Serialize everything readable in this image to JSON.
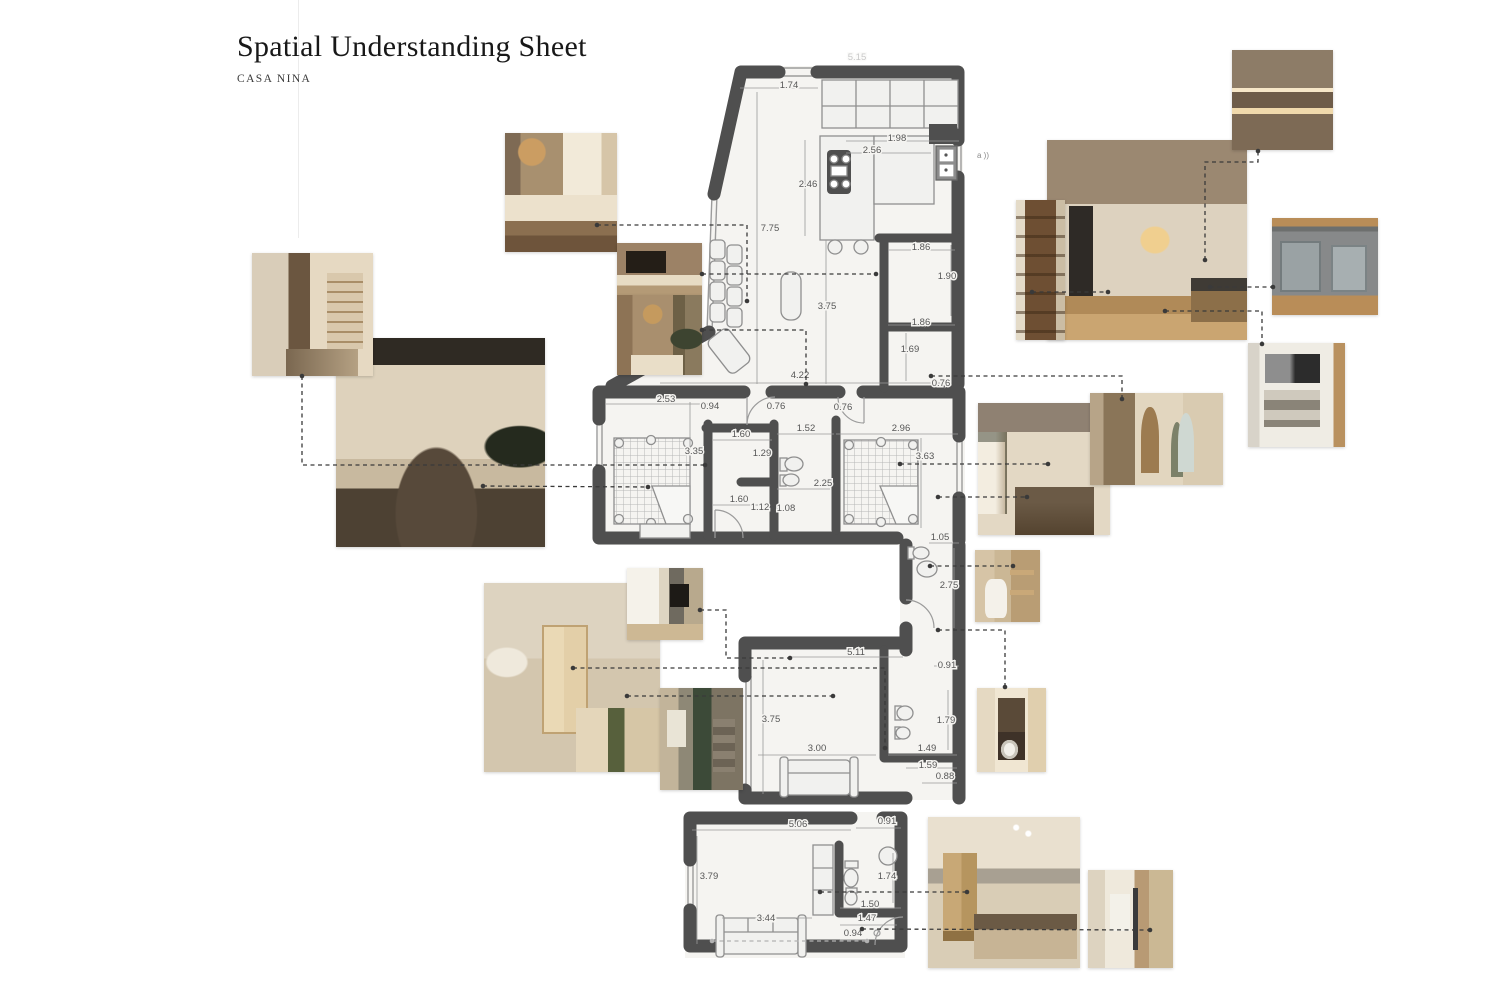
{
  "header": {
    "title": "Spatial Understanding Sheet",
    "subtitle": "CASA NINA"
  },
  "plan": {
    "dimensions": [
      {
        "t": "5.15",
        "x": 857,
        "y": 60,
        "f": 1
      },
      {
        "t": "1.74",
        "x": 789,
        "y": 88
      },
      {
        "t": "1.98",
        "x": 897,
        "y": 141
      },
      {
        "t": "2.56",
        "x": 872,
        "y": 153
      },
      {
        "t": "2.46",
        "x": 808,
        "y": 187
      },
      {
        "t": "7.75",
        "x": 770,
        "y": 231
      },
      {
        "t": "1.86",
        "x": 921,
        "y": 250
      },
      {
        "t": "1.90",
        "x": 947,
        "y": 279
      },
      {
        "t": "3.75",
        "x": 827,
        "y": 309
      },
      {
        "t": "1.86",
        "x": 921,
        "y": 325
      },
      {
        "t": "1.69",
        "x": 910,
        "y": 352
      },
      {
        "t": "4.22",
        "x": 800,
        "y": 378
      },
      {
        "t": "0.76",
        "x": 941,
        "y": 386
      },
      {
        "t": "2.53",
        "x": 666,
        "y": 402
      },
      {
        "t": "0.94",
        "x": 710,
        "y": 409
      },
      {
        "t": "0.76",
        "x": 776,
        "y": 409
      },
      {
        "t": "0.76",
        "x": 843,
        "y": 410
      },
      {
        "t": "1.52",
        "x": 806,
        "y": 431
      },
      {
        "t": "2.96",
        "x": 901,
        "y": 431
      },
      {
        "t": "1.60",
        "x": 741,
        "y": 437
      },
      {
        "t": "3.35",
        "x": 694,
        "y": 454
      },
      {
        "t": "1.29",
        "x": 762,
        "y": 456
      },
      {
        "t": "3.63",
        "x": 925,
        "y": 459
      },
      {
        "t": "2.25",
        "x": 823,
        "y": 486
      },
      {
        "t": "1.60",
        "x": 739,
        "y": 502
      },
      {
        "t": "1.12",
        "x": 760,
        "y": 510
      },
      {
        "t": "1.08",
        "x": 786,
        "y": 511
      },
      {
        "t": "1.05",
        "x": 940,
        "y": 540
      },
      {
        "t": "2.75",
        "x": 949,
        "y": 588
      },
      {
        "t": "5.11",
        "x": 856,
        "y": 655
      },
      {
        "t": "0.91",
        "x": 947,
        "y": 668
      },
      {
        "t": "3.75",
        "x": 771,
        "y": 722
      },
      {
        "t": "1.79",
        "x": 946,
        "y": 723
      },
      {
        "t": "3.00",
        "x": 817,
        "y": 751
      },
      {
        "t": "1.49",
        "x": 927,
        "y": 751
      },
      {
        "t": "1.59",
        "x": 928,
        "y": 768
      },
      {
        "t": "0.88",
        "x": 945,
        "y": 779
      },
      {
        "t": "0.91",
        "x": 887,
        "y": 824
      },
      {
        "t": "5.06",
        "x": 798,
        "y": 827
      },
      {
        "t": "3.79",
        "x": 709,
        "y": 879
      },
      {
        "t": "1.74",
        "x": 887,
        "y": 879
      },
      {
        "t": "1.50",
        "x": 870,
        "y": 907
      },
      {
        "t": "3.44",
        "x": 766,
        "y": 921
      },
      {
        "t": "1.47",
        "x": 867,
        "y": 921
      },
      {
        "t": "0.94",
        "x": 853,
        "y": 936
      }
    ],
    "annotations": [
      {
        "t": "a ))",
        "x": 977,
        "y": 158
      }
    ],
    "dimension_lines": [
      [
        740,
        88,
        818,
        88
      ],
      [
        846,
        141,
        959,
        141
      ],
      [
        846,
        153,
        931,
        153
      ],
      [
        805,
        140,
        805,
        236
      ],
      [
        757,
        92,
        757,
        384
      ],
      [
        826,
        240,
        826,
        384
      ],
      [
        888,
        250,
        955,
        250
      ],
      [
        951,
        245,
        951,
        316
      ],
      [
        888,
        325,
        955,
        325
      ],
      [
        906,
        333,
        906,
        381
      ],
      [
        660,
        383,
        940,
        383
      ],
      [
        606,
        404,
        712,
        404
      ],
      [
        777,
        434,
        834,
        434
      ],
      [
        836,
        434,
        958,
        434
      ],
      [
        713,
        440,
        772,
        440
      ],
      [
        690,
        402,
        690,
        524
      ],
      [
        921,
        438,
        921,
        528
      ],
      [
        777,
        489,
        830,
        489
      ],
      [
        713,
        505,
        770,
        505
      ],
      [
        929,
        543,
        959,
        543
      ],
      [
        954,
        548,
        954,
        628
      ],
      [
        790,
        657,
        903,
        657
      ],
      [
        934,
        666,
        959,
        666
      ],
      [
        763,
        660,
        763,
        794
      ],
      [
        758,
        755,
        876,
        755
      ],
      [
        948,
        690,
        948,
        750
      ],
      [
        888,
        755,
        957,
        755
      ],
      [
        906,
        768,
        957,
        768
      ],
      [
        922,
        783,
        957,
        783
      ],
      [
        692,
        830,
        851,
        830
      ],
      [
        856,
        828,
        901,
        828
      ],
      [
        697,
        836,
        697,
        944
      ],
      [
        893,
        853,
        893,
        903
      ],
      [
        840,
        908,
        901,
        908
      ],
      [
        722,
        918,
        812,
        918
      ],
      [
        840,
        925,
        897,
        925
      ],
      [
        840,
        940,
        868,
        940
      ]
    ]
  },
  "leader_lines": {
    "dark": [
      {
        "pts": [
          [
            597,
            225
          ],
          [
            747,
            225
          ],
          [
            747,
            301
          ]
        ]
      },
      {
        "pts": [
          [
            702,
            274
          ],
          [
            876,
            274
          ]
        ]
      },
      {
        "pts": [
          [
            702,
            330
          ],
          [
            806,
            330
          ],
          [
            806,
            384
          ]
        ]
      },
      {
        "pts": [
          [
            302,
            376
          ],
          [
            302,
            465
          ],
          [
            705,
            465
          ]
        ]
      },
      {
        "pts": [
          [
            483,
            486
          ],
          [
            648,
            487
          ]
        ]
      },
      {
        "pts": [
          [
            900,
            464
          ],
          [
            1048,
            464
          ]
        ]
      },
      {
        "pts": [
          [
            931,
            376
          ],
          [
            1122,
            376
          ],
          [
            1122,
            399
          ]
        ]
      },
      {
        "pts": [
          [
            1205,
            260
          ],
          [
            1205,
            162
          ],
          [
            1258,
            162
          ],
          [
            1258,
            151
          ]
        ]
      },
      {
        "pts": [
          [
            1032,
            292
          ],
          [
            1108,
            292
          ]
        ]
      },
      {
        "pts": [
          [
            1210,
            287
          ],
          [
            1273,
            287
          ]
        ]
      },
      {
        "pts": [
          [
            1165,
            311
          ],
          [
            1262,
            311
          ],
          [
            1262,
            344
          ]
        ]
      },
      {
        "pts": [
          [
            938,
            497
          ],
          [
            1027,
            497
          ]
        ]
      },
      {
        "pts": [
          [
            930,
            566
          ],
          [
            1013,
            566
          ]
        ]
      },
      {
        "pts": [
          [
            938,
            630
          ],
          [
            1005,
            630
          ],
          [
            1005,
            687
          ]
        ]
      },
      {
        "pts": [
          [
            700,
            610
          ],
          [
            726,
            610
          ],
          [
            726,
            658
          ],
          [
            790,
            658
          ]
        ]
      },
      {
        "pts": [
          [
            573,
            668
          ],
          [
            885,
            668
          ],
          [
            885,
            748
          ]
        ]
      },
      {
        "pts": [
          [
            627,
            696
          ],
          [
            833,
            696
          ]
        ]
      },
      {
        "pts": [
          [
            820,
            892
          ],
          [
            967,
            892
          ]
        ]
      },
      {
        "pts": [
          [
            862,
            929
          ],
          [
            1150,
            930
          ]
        ]
      }
    ],
    "light": [
      {
        "pts": [
          [
            712,
            941
          ],
          [
            867,
            941
          ]
        ]
      }
    ]
  },
  "photos": [
    {
      "name": "living-room-render",
      "style": "living",
      "x": 505,
      "y": 133,
      "w": 112,
      "h": 119,
      "z": 2
    },
    {
      "name": "tv-wall-render",
      "style": "tv",
      "x": 617,
      "y": 243,
      "w": 85,
      "h": 52,
      "z": 2
    },
    {
      "name": "living-pendant-render",
      "style": "pendant",
      "x": 617,
      "y": 295,
      "w": 85,
      "h": 80,
      "z": 2
    },
    {
      "name": "hall-wardrobe-render",
      "style": "wardrobe",
      "x": 252,
      "y": 253,
      "w": 121,
      "h": 123,
      "z": 3
    },
    {
      "name": "master-bedroom-render",
      "style": "bedroomdark",
      "x": 336,
      "y": 338,
      "w": 209,
      "h": 209,
      "z": 2
    },
    {
      "name": "kitchen-render",
      "style": "kitchen",
      "x": 1047,
      "y": 140,
      "w": 200,
      "h": 200,
      "z": 2
    },
    {
      "name": "pantry-render",
      "style": "pantry",
      "x": 1016,
      "y": 200,
      "w": 49,
      "h": 140,
      "z": 3
    },
    {
      "name": "shelf-niche-render",
      "style": "shelf",
      "x": 1232,
      "y": 50,
      "w": 101,
      "h": 100,
      "z": 2
    },
    {
      "name": "under-sink-bins-render",
      "style": "bins",
      "x": 1272,
      "y": 218,
      "w": 106,
      "h": 97,
      "z": 2
    },
    {
      "name": "appliance-cabinet-render",
      "style": "appliance",
      "x": 1248,
      "y": 343,
      "w": 97,
      "h": 104,
      "z": 2
    },
    {
      "name": "second-bedroom-render",
      "style": "bedroom2",
      "x": 978,
      "y": 403,
      "w": 132,
      "h": 132,
      "z": 2
    },
    {
      "name": "hallway-arch-render",
      "style": "hallway",
      "x": 1090,
      "y": 393,
      "w": 133,
      "h": 92,
      "z": 3
    },
    {
      "name": "wc-toilet-render",
      "style": "toiletph",
      "x": 975,
      "y": 550,
      "w": 65,
      "h": 72,
      "z": 2
    },
    {
      "name": "closet-lounge-render",
      "style": "closet",
      "x": 484,
      "y": 583,
      "w": 176,
      "h": 189,
      "z": 2
    },
    {
      "name": "tv-curtain-render",
      "style": "tvcurtain",
      "x": 627,
      "y": 568,
      "w": 76,
      "h": 72,
      "z": 3
    },
    {
      "name": "green-shower-render",
      "style": "showergreen",
      "x": 660,
      "y": 688,
      "w": 83,
      "h": 102,
      "z": 3
    },
    {
      "name": "laundry-niche-render",
      "style": "laundry",
      "x": 977,
      "y": 688,
      "w": 69,
      "h": 84,
      "z": 2
    },
    {
      "name": "guest-room-render",
      "style": "bottombed",
      "x": 928,
      "y": 817,
      "w": 152,
      "h": 151,
      "z": 2
    },
    {
      "name": "shower-room-render",
      "style": "showerlight",
      "x": 1088,
      "y": 870,
      "w": 85,
      "h": 98,
      "z": 2
    }
  ],
  "colors": {
    "wall": "#4f4f4f",
    "paper": "#f5f4f1",
    "thin_line": "#9b9b9b",
    "dim_text": "#565656",
    "leader": "#3a3a3a",
    "leader_light": "#b2b2b2"
  }
}
